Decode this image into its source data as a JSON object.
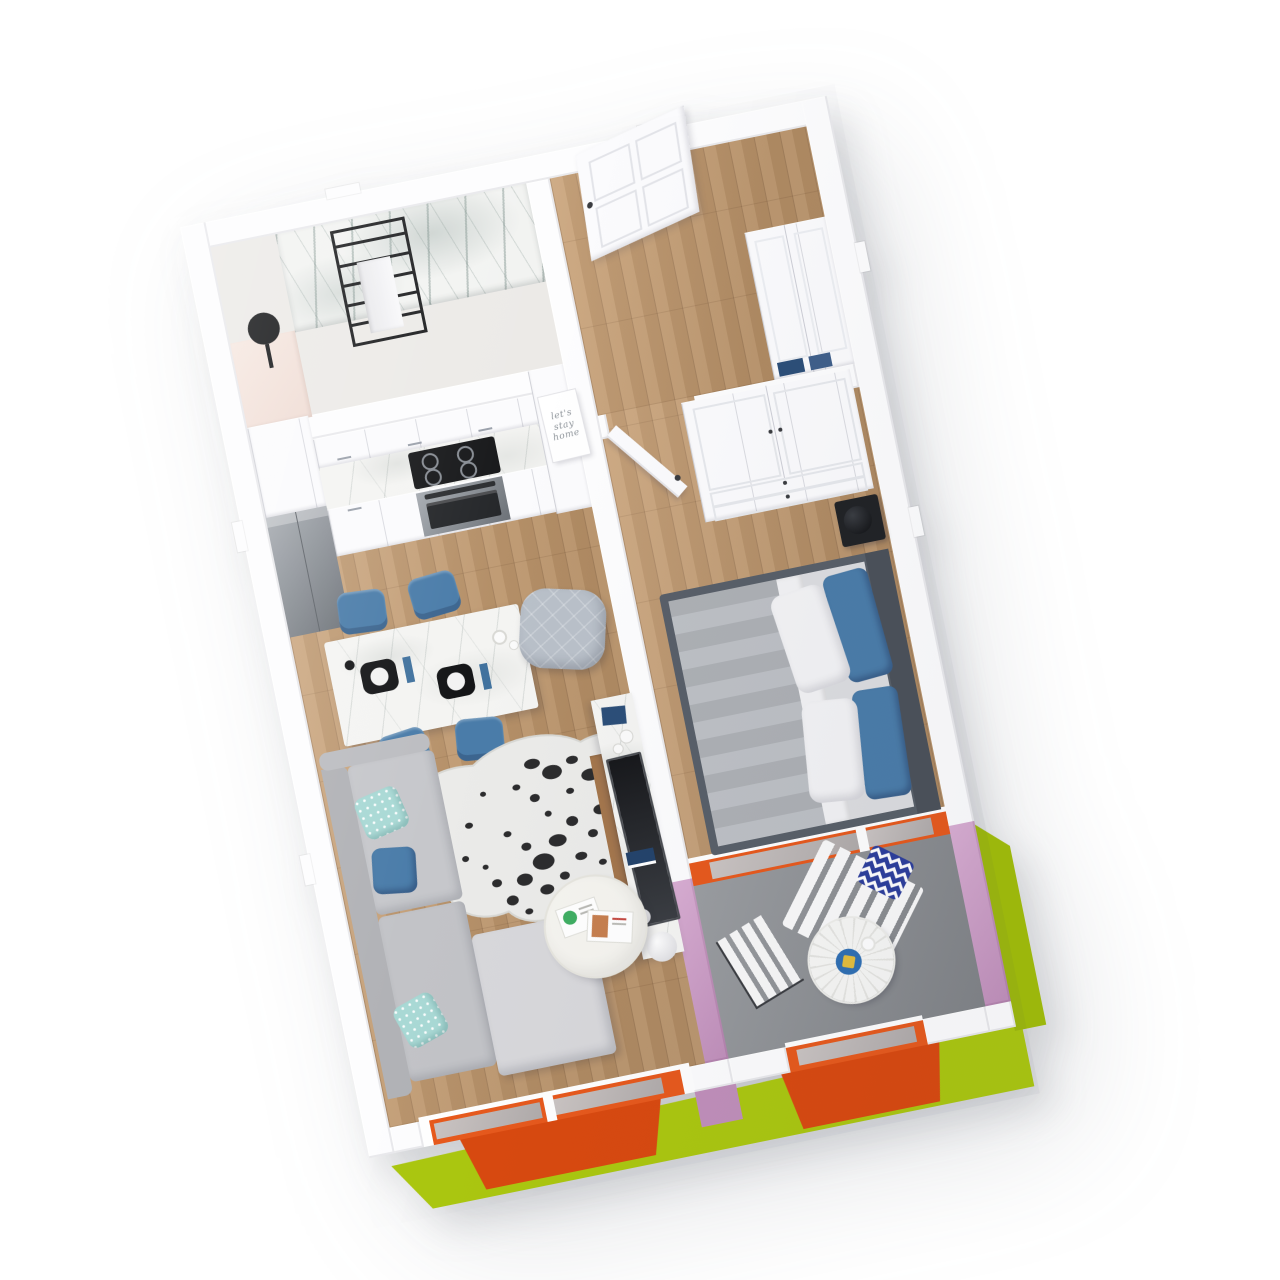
{
  "scene": {
    "type": "3d-floorplan-render",
    "rooms": [
      "bathroom",
      "kitchen",
      "entry-hall",
      "living-room",
      "bedroom",
      "balcony"
    ],
    "items": [
      "towel-ladder",
      "round-mirror",
      "fridge",
      "cooktop",
      "oven",
      "kitchen-cabinets",
      "dining-table",
      "dining-chairs",
      "armchair",
      "cowhide-rug",
      "corner-sofa",
      "coffee-table",
      "media-console",
      "tv",
      "floor-lamp",
      "front-door",
      "hall-closet",
      "wardrobe",
      "bedroom-door",
      "nightstand",
      "double-bed",
      "balcony-lounger",
      "folding-chair",
      "bistro-table",
      "chevron-pillow"
    ]
  },
  "wall_art": {
    "line1": "let's",
    "line2": "stay",
    "line3": "home"
  },
  "colors": {
    "c_orange": "#e7591c",
    "c_orange_dark": "#d9490f",
    "c_green": "#abc70f",
    "c_green_dark": "#9cb70c",
    "c_pink": "#d9aed3",
    "c_pink_dark": "#c08fba",
    "c_wood": "#c59b6e",
    "c_concrete": "#8f9296",
    "c_wall": "#fdfdfe",
    "c_marble": "#f4f4f2",
    "c_steel": "#a6abb1",
    "c_steel_dark": "#6d7278",
    "c_black": "#17181a",
    "c_sofa": "#c6c7cb",
    "c_sofa_light": "#d8d8db",
    "c_sofa_back": "#b1b2b6",
    "c_chair_blue": "#4a7ca9",
    "c_teal": "#a9d9d5",
    "c_navy": "#2c4e78",
    "c_duvet": "#b6b9be",
    "c_mattress": "#dcdde0",
    "c_headboard": "#4b5159",
    "c_plate_blue": "#2f6fb3",
    "c_lemon": "#e4bd3c",
    "c_chevron": "#2c3e9c"
  }
}
